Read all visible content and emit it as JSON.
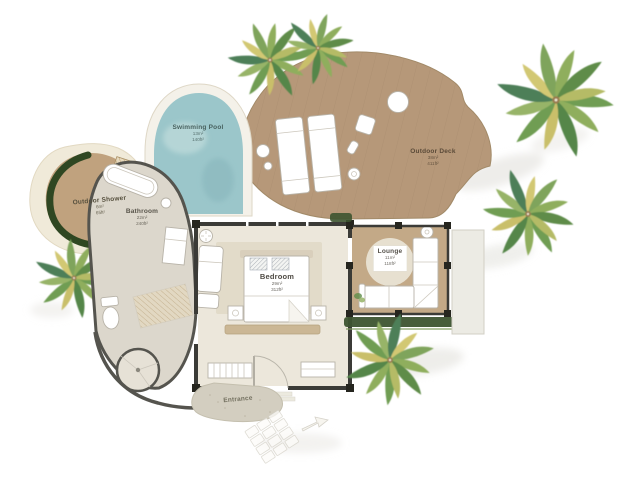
{
  "rooms": {
    "swimming_pool": {
      "label": "Swimming Pool",
      "area_m2": "13m²",
      "area_ft2": "140ft²"
    },
    "outdoor_deck": {
      "label": "Outdoor Deck",
      "area_m2": "38m²",
      "area_ft2": "411ft²"
    },
    "outdoor_shower": {
      "label": "Outdoor Shower",
      "area_m2": "6m²",
      "area_ft2": "65ft²"
    },
    "bathroom": {
      "label": "Bathroom",
      "area_m2": "22m²",
      "area_ft2": "240ft²"
    },
    "bedroom": {
      "label": "Bedroom",
      "area_m2": "29m²",
      "area_ft2": "312ft²"
    },
    "lounge": {
      "label": "Lounge",
      "area_m2": "11m²",
      "area_ft2": "118ft²"
    },
    "entrance": {
      "label": "Entrance"
    }
  },
  "colors": {
    "deck": "#b69879",
    "lounge_floor": "#c3a987",
    "bedroom_floor": "#ece7db",
    "bedroom_rug": "#e2dbc9",
    "bathroom_floor": "#dcd7cc",
    "pool_water": "#9bc6ca",
    "pool_surround": "#f4f1e9",
    "sand": "#f0ead9",
    "shower_floor": "#c0a27e",
    "hedge_green": "#2f4722",
    "grass_green": "#3d5430",
    "wall_dark": "#3b3b37",
    "bath_wall": "#55544e",
    "entrance_stone": "#d3cec0",
    "shadow_gray": "#e0dfd9"
  }
}
